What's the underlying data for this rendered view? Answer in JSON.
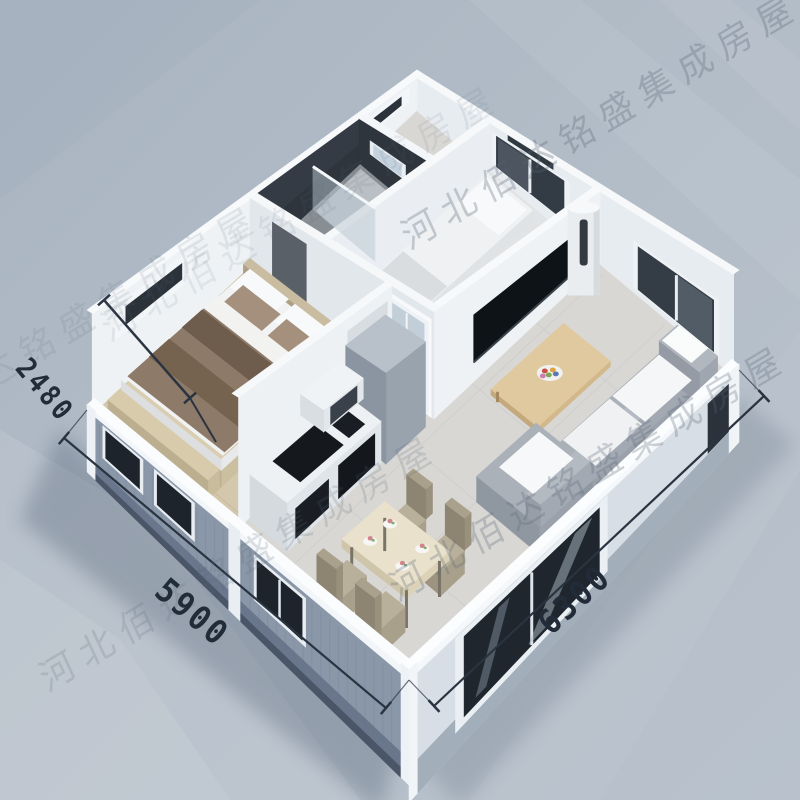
{
  "meta": {
    "type": "isometric-floorplan-render",
    "subject": "3D cutaway rendering of an expandable container house interior"
  },
  "watermark": {
    "text": "河北佰达铭盛集成房屋",
    "color": "#5a6676"
  },
  "dimensions": {
    "unit": "mm",
    "wall_height": {
      "label": "2480"
    },
    "side_left": {
      "label": "5900"
    },
    "side_right": {
      "label": "6300"
    }
  },
  "rooms": [
    {
      "id": "master-bedroom",
      "items": [
        "double-bed",
        "pillows",
        "striped-blanket",
        "foot-bench",
        "nightstand",
        "wall-ac-louver",
        "exterior-windows"
      ]
    },
    {
      "id": "bathroom",
      "items": [
        "toilet",
        "glass-shower-partition",
        "framed-window",
        "dark-tile-walls"
      ]
    },
    {
      "id": "small-bedroom",
      "items": [
        "single-bed",
        "desk-chair",
        "double-window",
        "vent-louver"
      ]
    },
    {
      "id": "kitchen",
      "items": [
        "counter",
        "cooktop",
        "wall-shelf",
        "tall-cabinet"
      ]
    },
    {
      "id": "dining-area",
      "items": [
        "dining-table",
        "chair",
        "chair",
        "chair",
        "chair",
        "tableware"
      ]
    },
    {
      "id": "living-room",
      "items": [
        "corner-sofa",
        "white-cushions",
        "coffee-table",
        "fruit-plate",
        "tv-panel",
        "column-ac-unit",
        "window",
        "sliding-glass-door"
      ]
    }
  ],
  "palette": {
    "background": "#b1bbc6",
    "floor": "#d8d7d4",
    "wood_floor": "#d3c7ac",
    "exterior_wall": "#8a97a8",
    "interior_wall": "#eef2f5",
    "dark_tile": "#343b44",
    "glass_dark": "#20262e",
    "sofa": "#a7aeb6",
    "wood_furniture": "#dcc49c",
    "dimension_text": "#222c39"
  }
}
